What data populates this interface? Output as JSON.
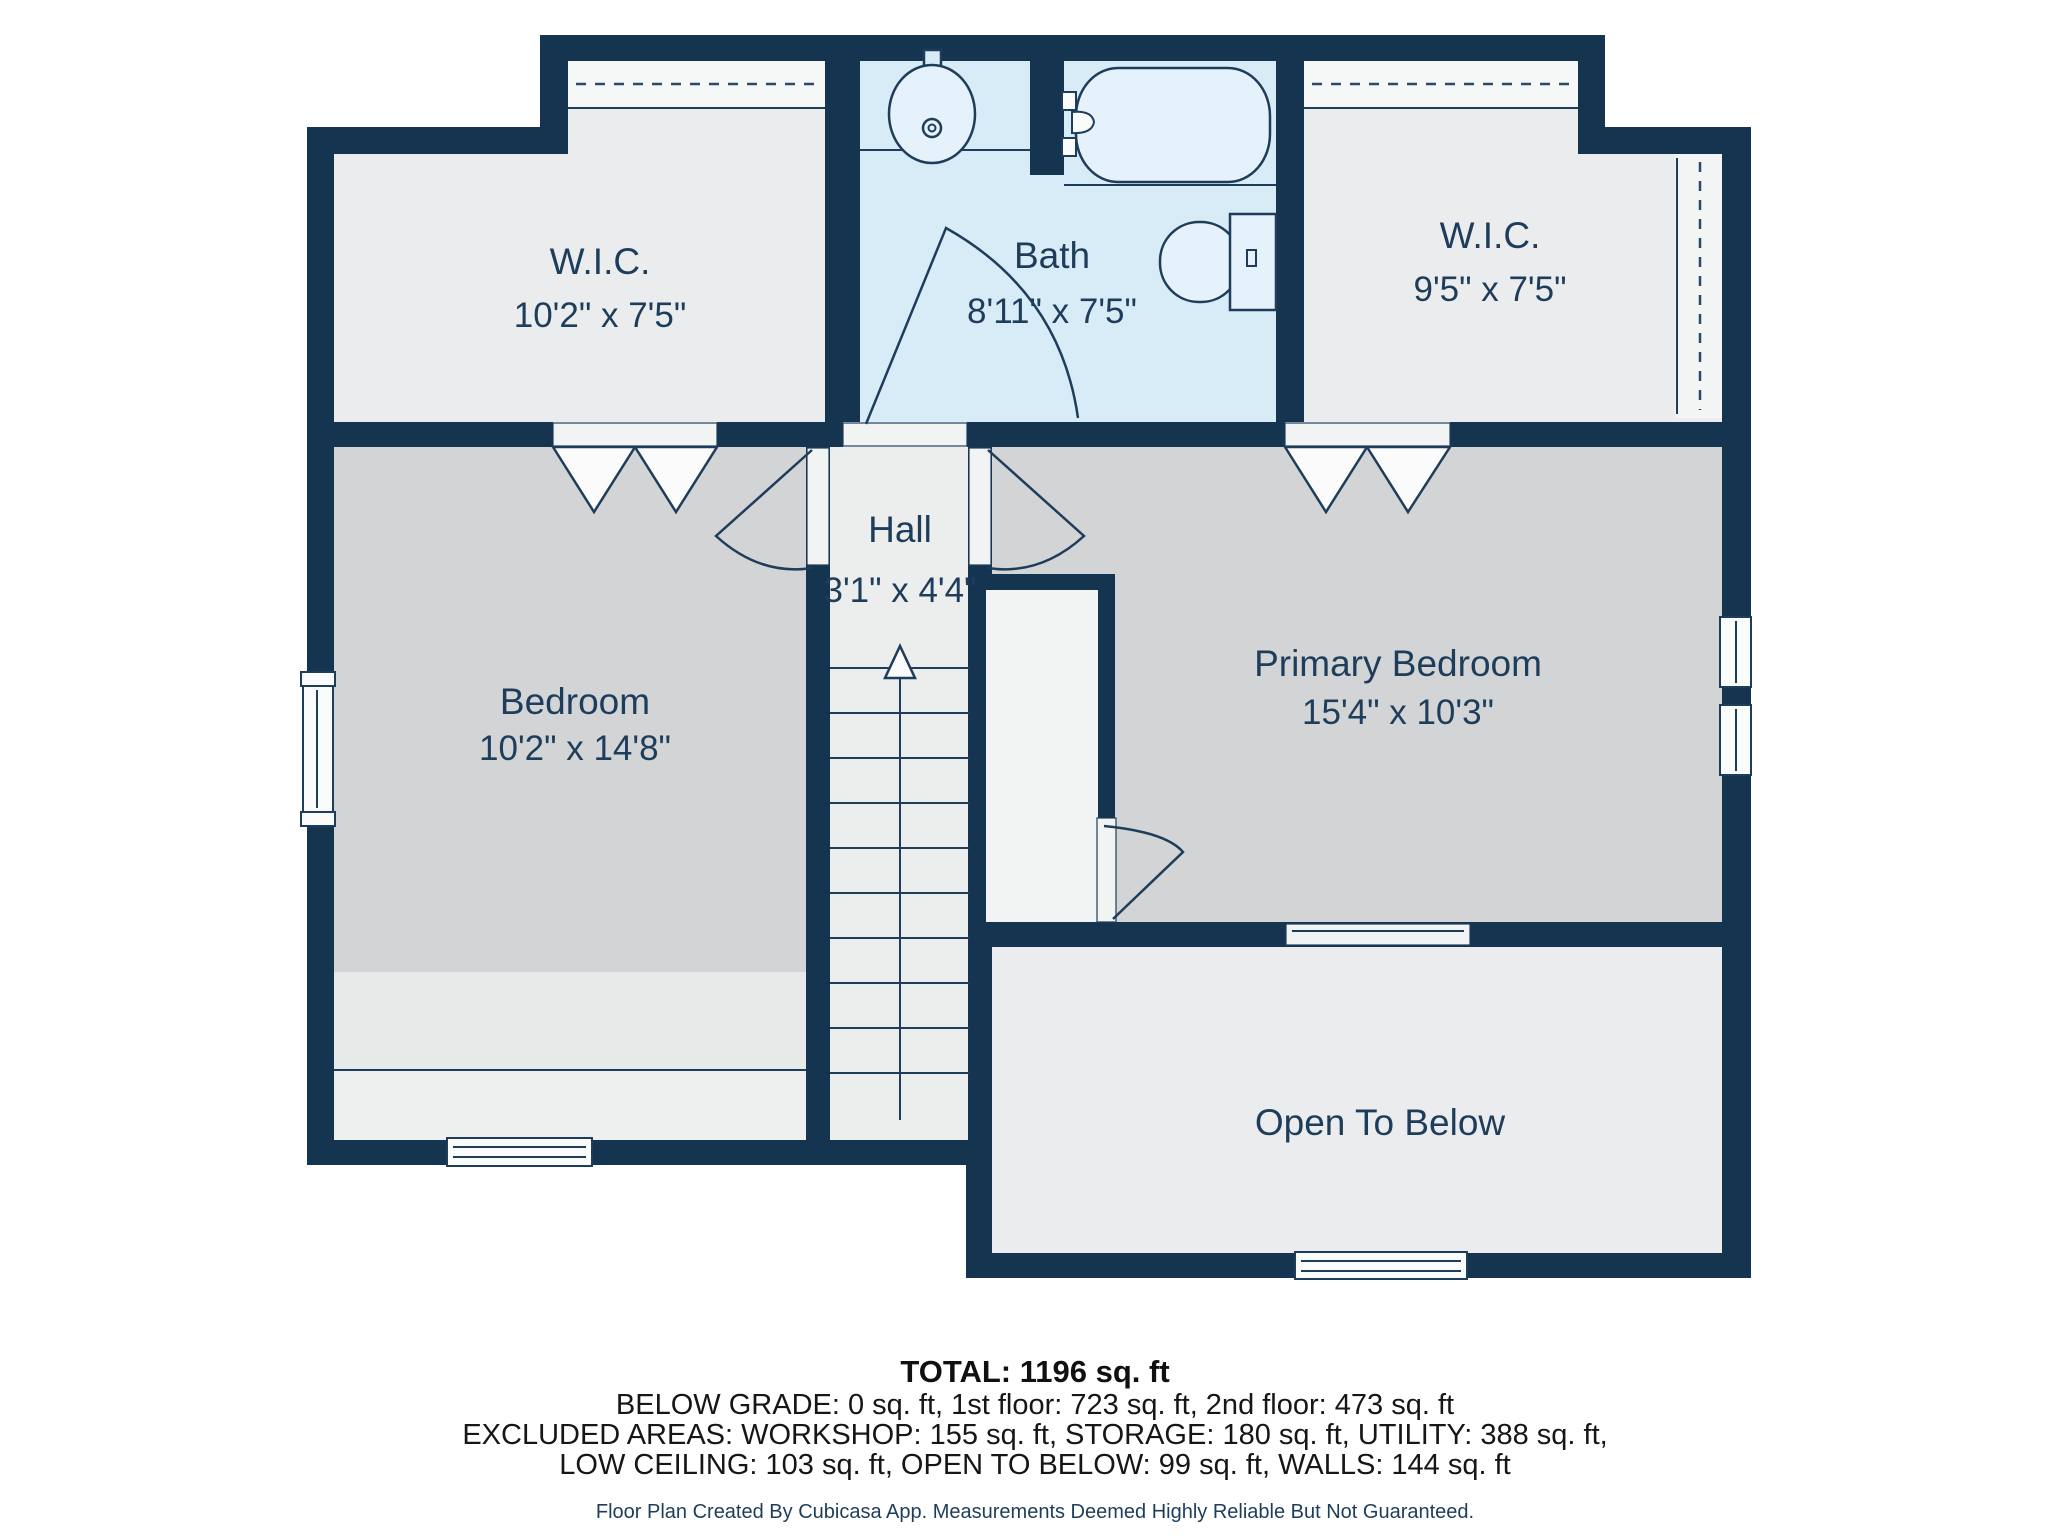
{
  "plan": {
    "rooms": {
      "wic_left": {
        "name": "W.I.C.",
        "dims": "10'2\" x 7'5\""
      },
      "bath": {
        "name": "Bath",
        "dims": "8'11\" x 7'5\""
      },
      "wic_right": {
        "name": "W.I.C.",
        "dims": "9'5\" x 7'5\""
      },
      "hall": {
        "name": "Hall",
        "dims": "3'1\" x 4'4\""
      },
      "bedroom": {
        "name": "Bedroom",
        "dims": "10'2\" x 14'8\""
      },
      "primary_bedroom": {
        "name": "Primary Bedroom",
        "dims": "15'4\" x 10'3\""
      },
      "open_to_below": {
        "name": "Open To Below"
      }
    },
    "colors": {
      "wall": "#143450",
      "label_text": "#1e3d5b",
      "bedroom_floor": "#d2d4d5",
      "light_floor": "#ebeced",
      "bath_floor": "#d8ecf7"
    }
  },
  "footer": {
    "total": "TOTAL: 1196 sq. ft",
    "line2": "BELOW GRADE: 0 sq. ft, 1st floor: 723 sq. ft, 2nd floor: 473 sq. ft",
    "line3": "EXCLUDED AREAS: WORKSHOP: 155 sq. ft, STORAGE: 180 sq. ft, UTILITY: 388 sq. ft,",
    "line4": "LOW CEILING: 103 sq. ft, OPEN TO BELOW: 99 sq. ft, WALLS: 144 sq. ft",
    "disclaimer": "Floor Plan Created By Cubicasa App. Measurements Deemed Highly Reliable But Not Guaranteed."
  }
}
